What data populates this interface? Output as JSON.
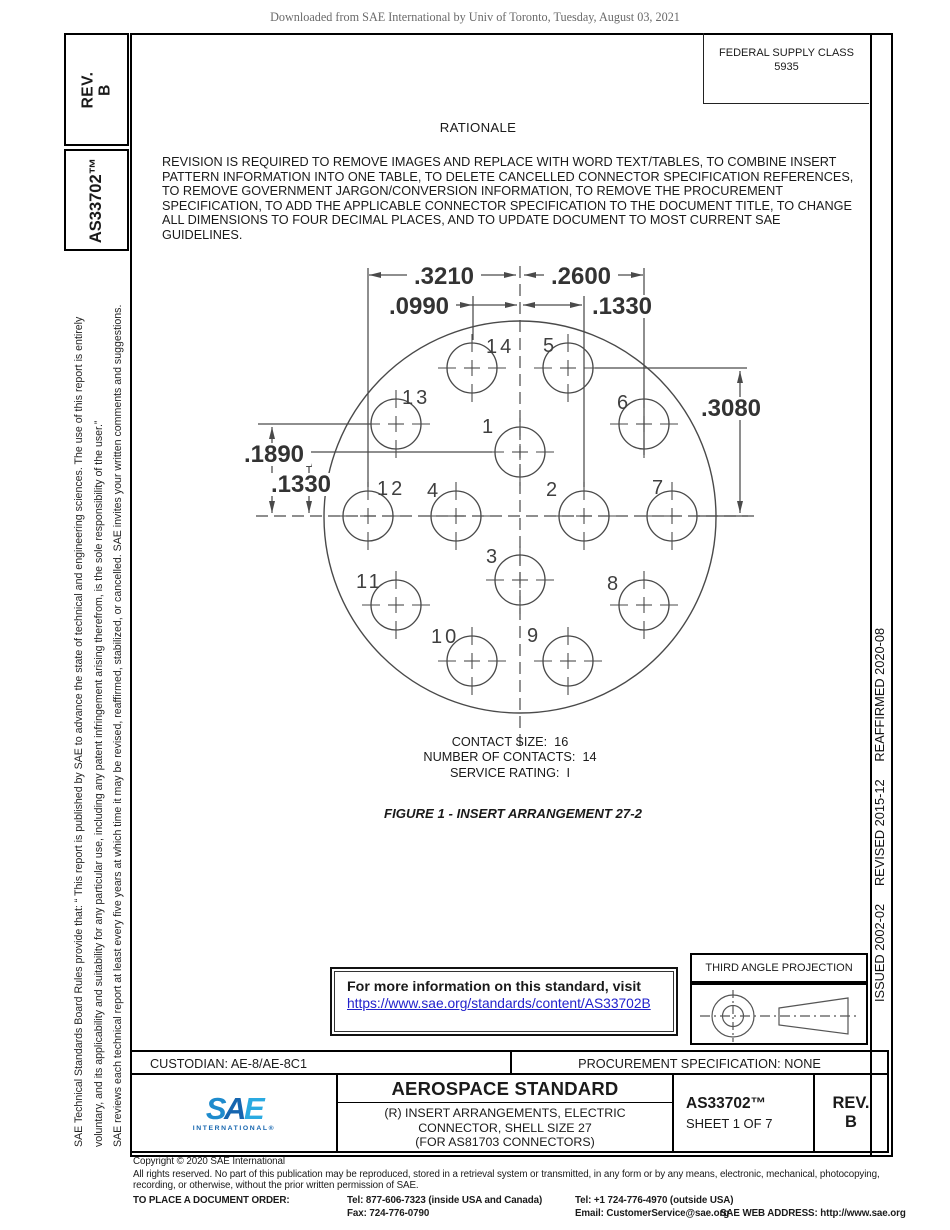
{
  "page": {
    "watermark": "Downloaded from SAE International by Univ of Toronto, Tuesday, August 03, 2021",
    "colors": {
      "link": "#2222cc",
      "sae_s": "#1e8bcd",
      "sae_a": "#1565af",
      "sae_e": "#2aaae1",
      "drawing_line": "#4a4a4a"
    }
  },
  "left_margin": {
    "rev_label": "REV.",
    "rev_value": "B",
    "doc_number": "AS33702™",
    "boilerplate": [
      "SAE Technical Standards Board Rules provide that: “ This report is published by SAE to advance the state of technical and engineering sciences. The use of this report is entirely",
      "voluntary, and its applicability and suitability for any particular use, including any patent infringement arising therefrom, is the sole responsibility of the user.”",
      "SAE reviews each technical report at least every five years at which time it may be revised, reaffirmed, stabilized, or cancelled. SAE invites your written comments and suggestions."
    ]
  },
  "right_margin": {
    "history": "ISSUED 2002-02     REVISED 2015-12     REAFFIRMED 2020-08"
  },
  "header": {
    "federal_supply_class": [
      "FEDERAL SUPPLY CLASS",
      "5935"
    ]
  },
  "rationale": {
    "title": "RATIONALE",
    "lines": [
      "REVISION IS REQUIRED TO REMOVE IMAGES AND REPLACE WITH WORD TEXT/TABLES, TO COMBINE INSERT",
      "PATTERN INFORMATION INTO ONE TABLE, TO DELETE CANCELLED CONNECTOR SPECIFICATION REFERENCES,",
      "TO REMOVE GOVERNMENT JARGON/CONVERSION INFORMATION, TO REMOVE THE PROCUREMENT",
      "SPECIFICATION, TO ADD THE APPLICABLE CONNECTOR SPECIFICATION TO THE DOCUMENT TITLE, TO CHANGE",
      "ALL DIMENSIONS TO FOUR DECIMAL PLACES, AND TO UPDATE DOCUMENT TO MOST CURRENT SAE",
      "GUIDELINES."
    ]
  },
  "figure": {
    "caption": "FIGURE 1 - INSERT ARRANGEMENT 27-2",
    "notes": [
      "CONTACT SIZE:  16",
      "NUMBER OF CONTACTS:  14",
      "SERVICE RATING:  I"
    ],
    "contact_size": "16",
    "number_of_contacts": "14",
    "service_rating": "I",
    "insert_arrangement": "27-2",
    "circle": {
      "cx": 520,
      "cy": 517,
      "r": 196
    },
    "contact_radius": 25,
    "contacts": [
      {
        "n": "1",
        "cx": 520,
        "cy": 452,
        "lx": 482,
        "ly": 433
      },
      {
        "n": "2",
        "cx": 584,
        "cy": 516,
        "lx": 546,
        "ly": 496
      },
      {
        "n": "3",
        "cx": 520,
        "cy": 580,
        "lx": 486,
        "ly": 563
      },
      {
        "n": "4",
        "cx": 456,
        "cy": 516,
        "lx": 427,
        "ly": 497
      },
      {
        "n": "5",
        "cx": 568,
        "cy": 368,
        "lx": 543,
        "ly": 352
      },
      {
        "n": "6",
        "cx": 644,
        "cy": 424,
        "lx": 617,
        "ly": 409
      },
      {
        "n": "7",
        "cx": 672,
        "cy": 516,
        "lx": 652,
        "ly": 494
      },
      {
        "n": "8",
        "cx": 644,
        "cy": 605,
        "lx": 607,
        "ly": 590
      },
      {
        "n": "9",
        "cx": 568,
        "cy": 661,
        "lx": 527,
        "ly": 642
      },
      {
        "n": "10",
        "cx": 472,
        "cy": 661,
        "lx": 431,
        "ly": 643
      },
      {
        "n": "11",
        "cx": 396,
        "cy": 605,
        "lx": 356,
        "ly": 588
      },
      {
        "n": "12",
        "cx": 368,
        "cy": 516,
        "lx": 377,
        "ly": 495
      },
      {
        "n": "13",
        "cx": 396,
        "cy": 424,
        "lx": 402,
        "ly": 404
      },
      {
        "n": "14",
        "cx": 472,
        "cy": 368,
        "lx": 486,
        "ly": 353
      }
    ],
    "solid_lines": [
      [
        368,
        268,
        368,
        487
      ],
      [
        473,
        296,
        473,
        340
      ],
      [
        584,
        296,
        584,
        487
      ],
      [
        644,
        268,
        644,
        455
      ],
      [
        258,
        424,
        371,
        424
      ],
      [
        302,
        452,
        492,
        452
      ],
      [
        595,
        368,
        747,
        368
      ],
      [
        698,
        516,
        748,
        516
      ],
      [
        369,
        275,
        516,
        275
      ],
      [
        524,
        275,
        643,
        275
      ],
      [
        448,
        305,
        517,
        305
      ],
      [
        523,
        305,
        582,
        305
      ],
      [
        272,
        427,
        272,
        513
      ],
      [
        309,
        455,
        309,
        513
      ],
      [
        740,
        371,
        740,
        513
      ]
    ],
    "dashed_lines": [
      [
        520,
        266,
        520,
        750
      ],
      [
        256,
        516,
        756,
        516
      ]
    ],
    "arrows": [
      [
        369,
        275,
        "L"
      ],
      [
        516,
        275,
        "R"
      ],
      [
        524,
        275,
        "L"
      ],
      [
        643,
        275,
        "R"
      ],
      [
        472,
        305,
        "R"
      ],
      [
        517,
        305,
        "R"
      ],
      [
        523,
        305,
        "L"
      ],
      [
        582,
        305,
        "R"
      ],
      [
        272,
        427,
        "U"
      ],
      [
        272,
        513,
        "D"
      ],
      [
        309,
        455,
        "U"
      ],
      [
        309,
        513,
        "D"
      ],
      [
        740,
        371,
        "U"
      ],
      [
        740,
        513,
        "D"
      ]
    ],
    "dim_labels": [
      {
        "text": ".3210",
        "x": 444,
        "y": 284
      },
      {
        "text": ".2600",
        "x": 581,
        "y": 284
      },
      {
        "text": ".0990",
        "x": 419,
        "y": 314
      },
      {
        "text": ".1330",
        "x": 622,
        "y": 314
      },
      {
        "text": ".3080",
        "x": 731,
        "y": 416
      },
      {
        "text": ".1890",
        "x": 274,
        "y": 462
      },
      {
        "text": ".1330",
        "x": 301,
        "y": 492
      }
    ]
  },
  "info_box": {
    "text": "For more information on this standard, visit",
    "url": "https://www.sae.org/standards/content/AS33702B"
  },
  "projection": {
    "label": "THIRD ANGLE PROJECTION"
  },
  "custodian_row": {
    "custodian": "CUSTODIAN: AE-8/AE-8C1",
    "procurement": "PROCUREMENT SPECIFICATION: NONE"
  },
  "title_block": {
    "logo_letters": [
      "S",
      "A",
      "E"
    ],
    "logo_sub": "INTERNATIONAL®",
    "title": "AEROSPACE STANDARD",
    "subtitle": [
      "(R) INSERT ARRANGEMENTS, ELECTRIC",
      "CONNECTOR, SHELL SIZE 27",
      "(FOR AS81703 CONNECTORS)"
    ],
    "doc_number": "AS33702™",
    "sheet": "SHEET 1 OF 7",
    "rev_label": "REV.",
    "rev_value": "B"
  },
  "footer": {
    "copyright": "Copyright © 2020 SAE International",
    "rights": [
      "All rights reserved. No part of this publication may be reproduced, stored in a retrieval system or transmitted, in any form or by any means, electronic, mechanical, photocopying,",
      "recording, or otherwise, without the prior written permission of SAE."
    ],
    "order_label": "TO PLACE A DOCUMENT ORDER:",
    "tel_inside": "Tel: 877-606-7323 (inside USA and Canada)",
    "tel_outside": "Tel: +1 724-776-4970 (outside USA)",
    "fax": "Fax: 724-776-0790",
    "email": "Email: CustomerService@sae.org",
    "web": "SAE WEB ADDRESS: http://www.sae.org"
  }
}
